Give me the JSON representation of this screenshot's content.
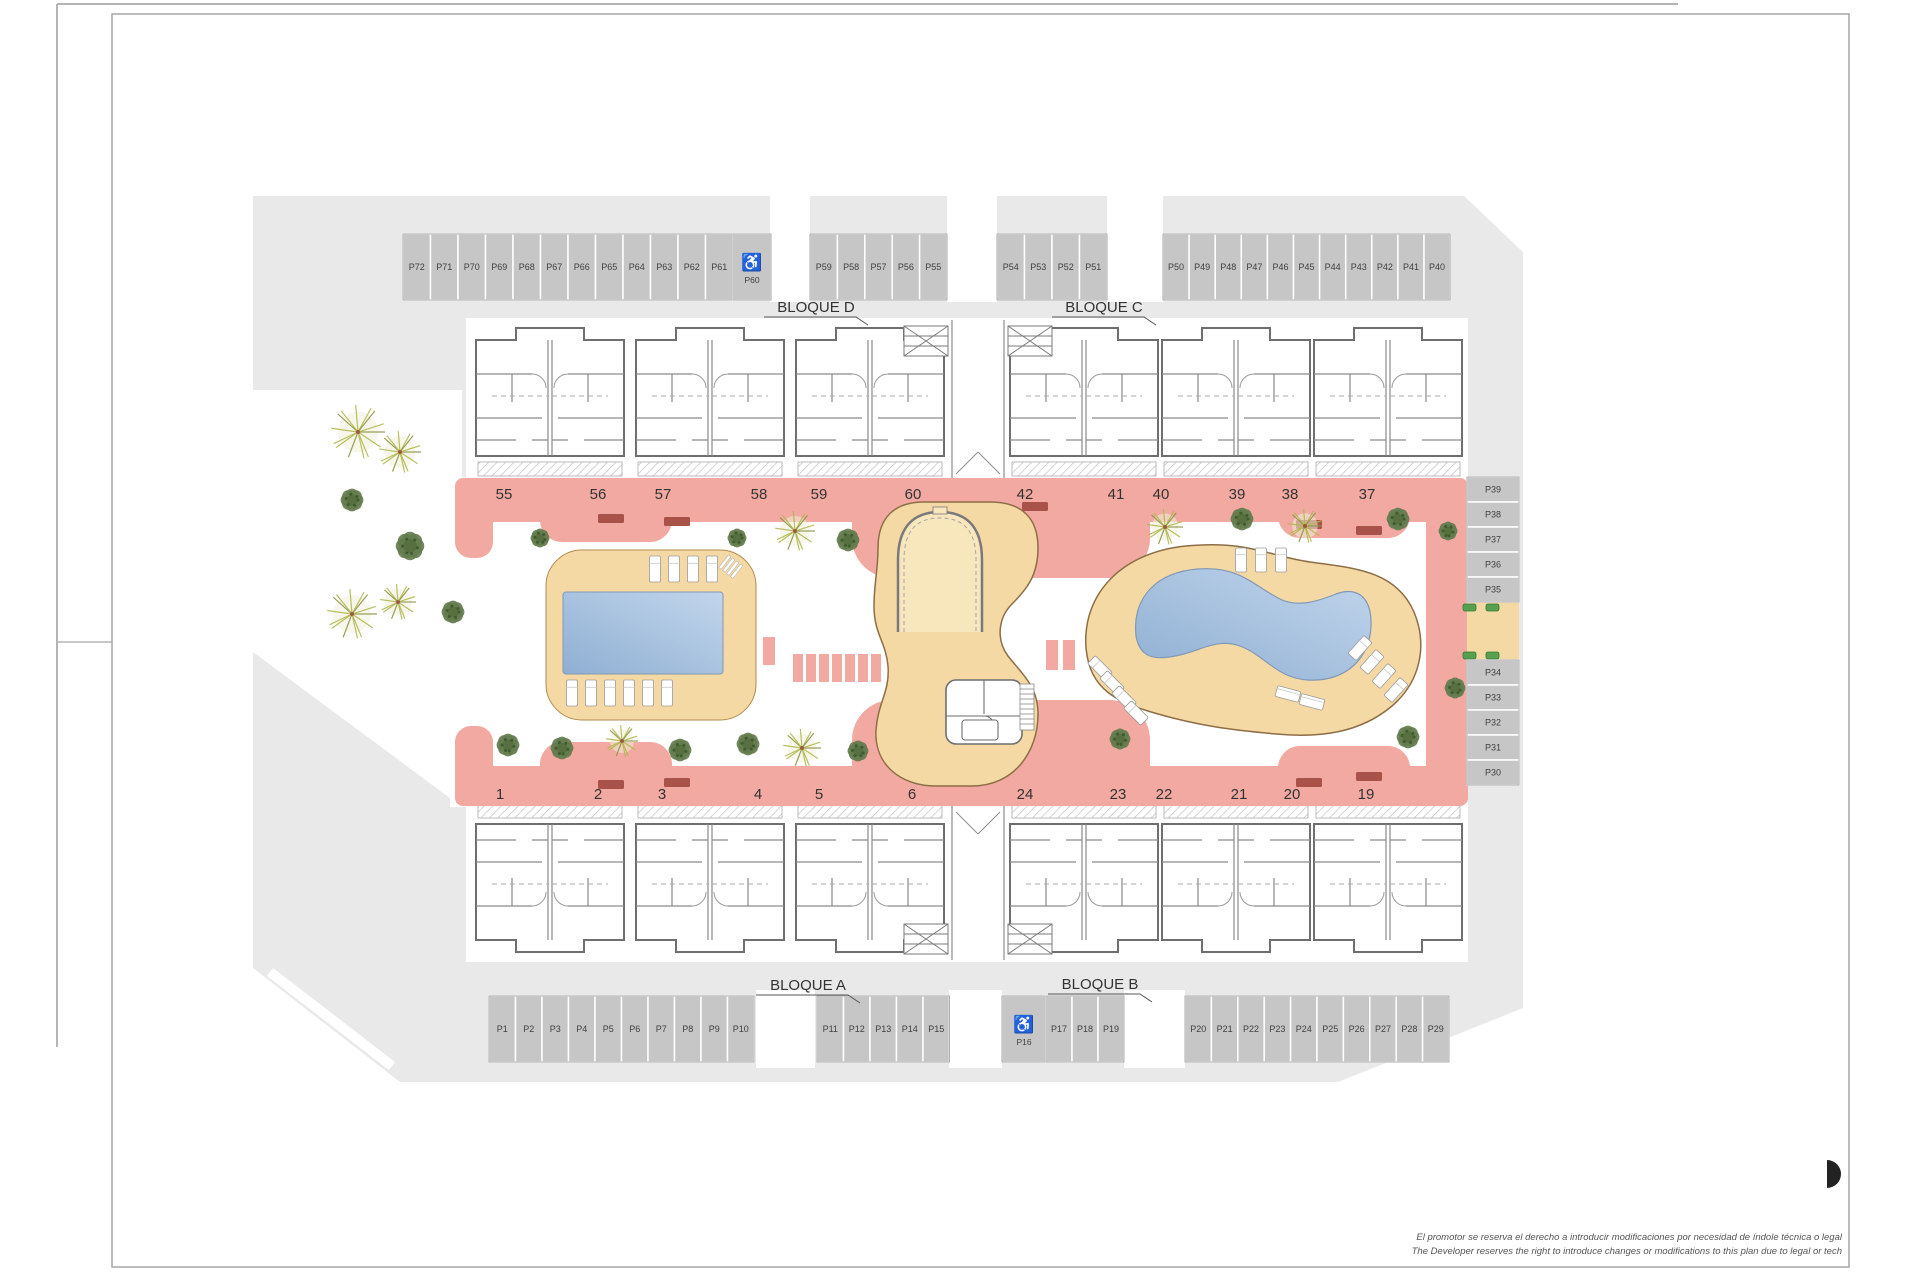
{
  "plan_title": "Residential complex site plan",
  "blocks": [
    {
      "id": "bloque-d",
      "label": "BLOQUE D",
      "x": 816,
      "y": 312
    },
    {
      "id": "bloque-c",
      "label": "BLOQUE C",
      "x": 1104,
      "y": 312
    },
    {
      "id": "bloque-a",
      "label": "BLOQUE A",
      "x": 808,
      "y": 990
    },
    {
      "id": "bloque-b",
      "label": "BLOQUE B",
      "x": 1100,
      "y": 989
    }
  ],
  "unit_numbers": {
    "top_y": 499,
    "top": [
      {
        "n": "55",
        "x": 504
      },
      {
        "n": "56",
        "x": 598
      },
      {
        "n": "57",
        "x": 663
      },
      {
        "n": "58",
        "x": 759
      },
      {
        "n": "59",
        "x": 819
      },
      {
        "n": "60",
        "x": 913
      },
      {
        "n": "42",
        "x": 1025
      },
      {
        "n": "41",
        "x": 1116
      },
      {
        "n": "40",
        "x": 1161
      },
      {
        "n": "39",
        "x": 1237
      },
      {
        "n": "38",
        "x": 1290
      },
      {
        "n": "37",
        "x": 1367
      }
    ],
    "bottom_y": 799,
    "bottom": [
      {
        "n": "1",
        "x": 500
      },
      {
        "n": "2",
        "x": 598
      },
      {
        "n": "3",
        "x": 662
      },
      {
        "n": "4",
        "x": 758
      },
      {
        "n": "5",
        "x": 819
      },
      {
        "n": "6",
        "x": 912
      },
      {
        "n": "24",
        "x": 1025
      },
      {
        "n": "23",
        "x": 1118
      },
      {
        "n": "22",
        "x": 1164
      },
      {
        "n": "21",
        "x": 1239
      },
      {
        "n": "20",
        "x": 1292
      },
      {
        "n": "19",
        "x": 1366
      }
    ]
  },
  "parking": {
    "accessible_icon": "wheelchair-icon",
    "accessible_glyph": "♿",
    "groups": [
      {
        "id": "top-a",
        "labels": [
          "P72",
          "P71",
          "P70",
          "P69",
          "P68",
          "P67",
          "P66",
          "P65",
          "P64",
          "P63",
          "P62",
          "P61"
        ]
      },
      {
        "id": "top-a-access",
        "labels": [
          "P60"
        ],
        "accessible": true
      },
      {
        "id": "top-b",
        "labels": [
          "P59",
          "P58",
          "P57",
          "P56",
          "P55"
        ]
      },
      {
        "id": "top-c",
        "labels": [
          "P54",
          "P53",
          "P52",
          "P51"
        ]
      },
      {
        "id": "top-d",
        "labels": [
          "P50",
          "P49",
          "P48",
          "P47",
          "P46",
          "P45",
          "P44",
          "P43",
          "P42",
          "P41",
          "P40"
        ]
      },
      {
        "id": "right-upper",
        "labels": [
          "P39",
          "P38",
          "P37",
          "P36",
          "P35"
        ]
      },
      {
        "id": "right-lower",
        "labels": [
          "P34",
          "P33",
          "P32",
          "P31",
          "P30"
        ]
      },
      {
        "id": "bottom-a",
        "labels": [
          "P1",
          "P2",
          "P3",
          "P4",
          "P5",
          "P6",
          "P7",
          "P8",
          "P9",
          "P10"
        ]
      },
      {
        "id": "bottom-b",
        "labels": [
          "P11",
          "P12",
          "P13",
          "P14",
          "P15"
        ]
      },
      {
        "id": "bottom-access",
        "labels": [
          "P16"
        ],
        "accessible": true
      },
      {
        "id": "bottom-c",
        "labels": [
          "P17",
          "P18",
          "P19"
        ]
      },
      {
        "id": "bottom-d",
        "labels": [
          "P20",
          "P21",
          "P22",
          "P23",
          "P24",
          "P25",
          "P26",
          "P27",
          "P28",
          "P29"
        ]
      }
    ]
  },
  "disclaimer": {
    "line1": "El promotor se reserva el derecho a introducir modificaciones por necesidad de índole técnica o legal",
    "line2": "The Developer reserves the right to introduce changes or modifications to this plan due to legal or tech"
  },
  "colors": {
    "site": "#e9e9e9",
    "stall": "#c6c6c6",
    "stall_edge": "#9a9a9a",
    "stall_label": "#3f3f3f",
    "walkway": "#f2a9a1",
    "bench": "#a8524a",
    "deck": "#f5d9a4",
    "deck_edge": "#b08c50",
    "pool_dark": "#8fafd3",
    "pool_light": "#c2d6ec",
    "pool_edge": "#8099b5",
    "wall": "#6e6e6e",
    "wall_inner": "#8a8a8a",
    "tree_light": "#b3b84f",
    "tree_light2": "#8f9447",
    "tree_dark": "#647c4e",
    "tree_dark2": "#3f5c30",
    "hedge": "#58a050",
    "frame": "#a6a6a6",
    "text": "#3a3a3a"
  }
}
